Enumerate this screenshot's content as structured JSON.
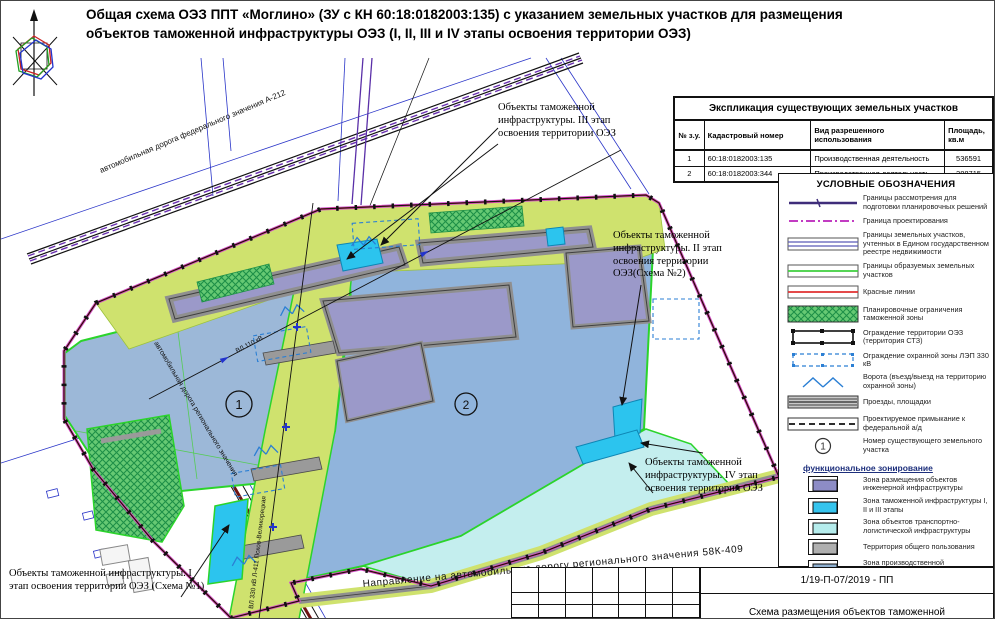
{
  "title": {
    "line1": "Общая схема ОЭЗ ППТ «Моглино» (ЗУ с КН 60:18:0182003:135) с указанием земельных участков для размещения",
    "line2": "объектов таможенной инфраструктуры ОЭЗ (I, II, III и IV этапы освоения территории ОЭЗ)"
  },
  "plots_table": {
    "title": "Экспликация  существующих земельных участков",
    "headers": [
      "№ з.у.",
      "Кадастровый номер",
      "Вид разрешенного использования",
      "Площадь, кв.м"
    ],
    "rows": [
      {
        "num": "1",
        "cadastre": "60:18:0182003:135",
        "use": "Производственная деятельность",
        "area": "536591"
      },
      {
        "num": "2",
        "cadastre": "60:18:0182003:344",
        "use": "Производственная деятельность",
        "area": "288715"
      }
    ]
  },
  "legend": {
    "title": "УСЛОВНЫЕ ОБОЗНАЧЕНИЯ",
    "items": [
      {
        "label": "Границы рассмотрения для подготовки планировочных решений"
      },
      {
        "label": "Граница проектирования"
      },
      {
        "label": "Границы земельных участков, учтенных в Едином государственном реестре недвижимости"
      },
      {
        "label": "Границы образуемых земельных участков"
      },
      {
        "label": "Красные линии"
      },
      {
        "label": "Планировочные ограничения таможенной зоны"
      },
      {
        "label": "Ограждение территории ОЭЗ (территория СТЗ)"
      },
      {
        "label": "Ограждение охранной зоны ЛЭП 330 кВ"
      },
      {
        "label": "Ворота (въезд/выезд на территорию охранной зоны)"
      },
      {
        "label": "Проезды, площадки"
      },
      {
        "label": "Проектируемое примыкание к федеральной а/д"
      },
      {
        "label": "Номер существующего земельного участка",
        "symbol": "1"
      }
    ]
  },
  "zoning": {
    "title": "функциональное зонирование",
    "items": [
      {
        "label": "Зона размещения объектов инженерной инфраструктуры",
        "color": "#8d8cc6"
      },
      {
        "label": "Зона таможенной инфраструктуры I, II и III этапы",
        "color": "#35c4ee"
      },
      {
        "label": "Зона объектов транспортно-логистической инфраструктуры",
        "color": "#b5ecec"
      },
      {
        "label": "Территория общего пользования",
        "color": "#b0b0b0"
      },
      {
        "label": "Зона производственной деятельности",
        "color": "#8fb0d0"
      },
      {
        "label": "Зона охраны высоковольтных линий электропередач",
        "color": "#c9e26a"
      }
    ]
  },
  "callouts": {
    "stage3": "Объекты таможенной инфраструктуры. III этап освоения территории ОЭЗ",
    "stage2": "Объекты таможенной инфраструктуры. II этап освоения территории ОЭЗ(Схема №2)",
    "stage4": "Объекты таможенной инфраструктуры. IV этап освоения территории ОЭЗ",
    "stage1": "Объекты таможенной инфраструктуры. I этап освоения территории ОЭЗ (Схема №1)"
  },
  "map_labels": {
    "federal_road": "автомобильная дорога федерального значения А-212",
    "regional_road": "автомобильная дорога регионального значения",
    "direction_road": "Направление на автомобильную дорогу регионального значения 58К-409",
    "vl110": "ВЛ 110 кВ",
    "vl330": "ВЛ 330 кВ Л-411 Псков-Великорецкая",
    "plot1_number": "1",
    "plot2_number": "2"
  },
  "titleblock": {
    "code": "1/19-П-07/2019 - ПП",
    "doc_title": "Схема размещения объектов таможенной"
  },
  "colors": {
    "power_line_zone": "#cfe26e",
    "production_zone": "#93b5da",
    "engineering_zone": "#9b99c9",
    "customs_zone": "#2cc4ee",
    "transport_logistics_zone": "#c4eeee",
    "public_territory": "#9a9a9a",
    "formed_border_green": "#2bd42b",
    "design_border_magenta": "#cf4fcf",
    "red_line": "#cd2727",
    "lep_fence_blue": "#2b7fd4"
  }
}
